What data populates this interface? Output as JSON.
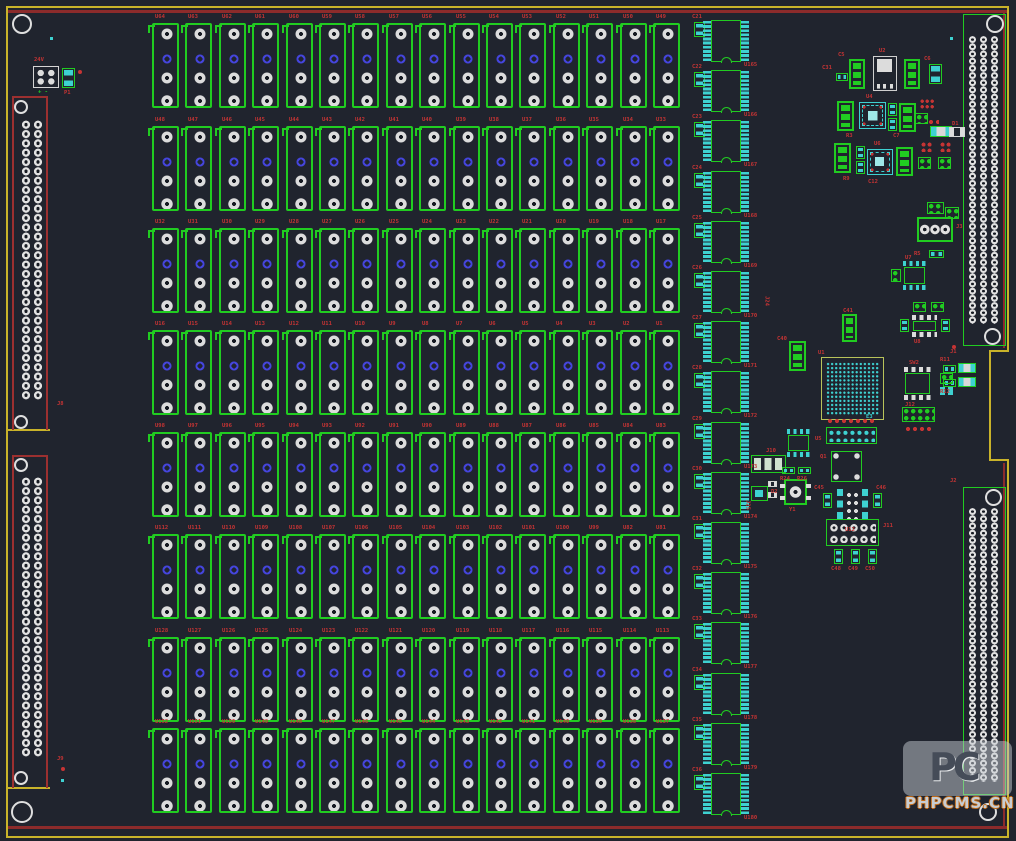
{
  "watermark": {
    "logo": "PC",
    "text": "PHPCMS.CN"
  },
  "colors": {
    "background": "#20242e",
    "board_edge": "#c9b32a",
    "board_line_red": "#8c2b2b",
    "silk_green": "#21cc21",
    "pad_silver": "#dcdcdc",
    "pad_cyan": "#3ed1d1",
    "via_blue": "#4545dd",
    "label_red": "#c63434"
  },
  "board": {
    "width": 1016,
    "height": 841
  },
  "outline": {
    "yellow": [
      [
        6,
        6,
        1003,
        2
      ],
      [
        6,
        6,
        2,
        832
      ],
      [
        6,
        836,
        1003,
        2
      ],
      [
        1007,
        6,
        2,
        346
      ],
      [
        990,
        350,
        19,
        2
      ],
      [
        989,
        350,
        2,
        111
      ],
      [
        990,
        459,
        19,
        2
      ],
      [
        1007,
        461,
        2,
        377
      ],
      [
        6,
        429,
        44,
        2
      ],
      [
        6,
        787,
        44,
        2
      ]
    ],
    "red": [
      [
        8,
        10,
        999,
        3
      ],
      [
        8,
        826,
        999,
        3
      ],
      [
        1003,
        12,
        2,
        336
      ],
      [
        1003,
        463,
        2,
        363
      ]
    ]
  },
  "mount_holes": [
    [
      12,
      14,
      20
    ],
    [
      11,
      801,
      22
    ],
    [
      986,
      15,
      18
    ],
    [
      979,
      803,
      18
    ],
    [
      14,
      100,
      14
    ],
    [
      14,
      415,
      14
    ],
    [
      14,
      458,
      14
    ],
    [
      14,
      771,
      14
    ],
    [
      984,
      328,
      17
    ],
    [
      985,
      489,
      17
    ]
  ],
  "testpoints": [
    [
      50,
      37
    ],
    [
      61,
      779
    ],
    [
      950,
      37
    ]
  ],
  "red_dots": [
    [
      61,
      767
    ],
    [
      78,
      70
    ],
    [
      952,
      345
    ]
  ],
  "relay_grid": {
    "x0": 152,
    "pitch_x": 33.4,
    "w": 27,
    "h": 85,
    "row_tops": [
      23,
      126,
      228,
      330,
      432,
      534,
      637,
      728
    ],
    "labels": [
      [
        "U64",
        "U63",
        "U62",
        "U61",
        "U60",
        "U59",
        "U58",
        "U57",
        "U56",
        "U55",
        "U54",
        "U53",
        "U52",
        "U51",
        "U50",
        "U49"
      ],
      [
        "U48",
        "U47",
        "U46",
        "U45",
        "U44",
        "U43",
        "U42",
        "U41",
        "U40",
        "U39",
        "U38",
        "U37",
        "U36",
        "U35",
        "U34",
        "U33"
      ],
      [
        "U32",
        "U31",
        "U30",
        "U29",
        "U28",
        "U27",
        "U26",
        "U25",
        "U24",
        "U23",
        "U22",
        "U21",
        "U20",
        "U19",
        "U18",
        "U17"
      ],
      [
        "U16",
        "U15",
        "U14",
        "U13",
        "U12",
        "U11",
        "U10",
        "U9",
        "U8",
        "U7",
        "U6",
        "U5",
        "U4",
        "U3",
        "U2",
        "U1"
      ],
      [
        "U98",
        "U97",
        "U96",
        "U95",
        "U94",
        "U93",
        "U92",
        "U91",
        "U90",
        "U89",
        "U88",
        "U87",
        "U86",
        "U85",
        "U84",
        "U83"
      ],
      [
        "U112",
        "U111",
        "U110",
        "U109",
        "U108",
        "U107",
        "U106",
        "U105",
        "U104",
        "U103",
        "U102",
        "U101",
        "U100",
        "U99",
        "U82",
        "U81"
      ],
      [
        "U128",
        "U127",
        "U126",
        "U125",
        "U124",
        "U123",
        "U122",
        "U121",
        "U120",
        "U119",
        "U118",
        "U117",
        "U116",
        "U115",
        "U114",
        "U113"
      ],
      [
        "U152",
        "U151",
        "U150",
        "U149",
        "U148",
        "U147",
        "U146",
        "U145",
        "U144",
        "U143",
        "U142",
        "U141",
        "U140",
        "U139",
        "U138",
        "U137"
      ]
    ]
  },
  "ic_column": {
    "cap_x": 694,
    "pin_l_x": 703,
    "body_x": 711,
    "pin_r_x": 741,
    "top0": 20,
    "pitch": 50.2,
    "body_w": 30,
    "body_h": 42,
    "ic_labels": [
      "U165",
      "U166",
      "U167",
      "U168",
      "U169",
      "U170",
      "U171",
      "U172",
      "U173",
      "U174",
      "U175",
      "U176",
      "U177",
      "U178",
      "U179",
      "U180"
    ],
    "cap_labels": [
      "C21",
      "C22",
      "C23",
      "C24",
      "C25",
      "C26",
      "C27",
      "C28",
      "C29",
      "C30",
      "C31",
      "C32",
      "C33",
      "C34",
      "C35",
      "C36"
    ]
  },
  "left_connectors": [
    {
      "x": 12,
      "y": 96,
      "w": 36,
      "h": 334,
      "pads": [
        20,
        120,
        24,
        280
      ]
    },
    {
      "x": 12,
      "y": 455,
      "w": 36,
      "h": 333,
      "pads": [
        20,
        477,
        24,
        280
      ]
    }
  ],
  "right_connectors": [
    {
      "x": 963,
      "y": 14,
      "w": 43,
      "h": 332,
      "pads": [
        967,
        36,
        33,
        288
      ]
    },
    {
      "x": 963,
      "y": 487,
      "w": 43,
      "h": 308,
      "pads": [
        967,
        508,
        33,
        274
      ]
    }
  ],
  "parts": [
    {
      "t": "w4",
      "x": 33,
      "y": 66,
      "w": 26,
      "h": 22
    },
    {
      "t": "gc2v",
      "x": 62,
      "y": 68,
      "w": 13,
      "h": 20
    },
    {
      "t": "g3",
      "x": 849,
      "y": 59,
      "w": 16,
      "h": 30
    },
    {
      "t": "vreg",
      "x": 873,
      "y": 56,
      "w": 24,
      "h": 35
    },
    {
      "t": "g3",
      "x": 904,
      "y": 59,
      "w": 16,
      "h": 30
    },
    {
      "t": "gc2h",
      "x": 836,
      "y": 73,
      "w": 12,
      "h": 8
    },
    {
      "t": "gc2v",
      "x": 929,
      "y": 64,
      "w": 13,
      "h": 20
    },
    {
      "t": "g3",
      "x": 837,
      "y": 101,
      "w": 17,
      "h": 30
    },
    {
      "t": "qfn",
      "x": 859,
      "y": 102,
      "w": 27,
      "h": 27
    },
    {
      "t": "gc2v",
      "x": 888,
      "y": 103,
      "w": 9,
      "h": 13
    },
    {
      "t": "gc2v",
      "x": 888,
      "y": 118,
      "w": 9,
      "h": 13
    },
    {
      "t": "g3",
      "x": 899,
      "y": 103,
      "w": 17,
      "h": 29
    },
    {
      "t": "r3x3",
      "x": 920,
      "y": 99,
      "w": 15,
      "h": 11
    },
    {
      "t": "g2x2",
      "x": 915,
      "y": 113,
      "w": 13,
      "h": 11
    },
    {
      "t": "rrow",
      "x": 928,
      "y": 119,
      "w": 11,
      "h": 6
    },
    {
      "t": "cyr",
      "x": 930,
      "y": 126,
      "w": 22,
      "h": 11
    },
    {
      "t": "g3",
      "x": 834,
      "y": 143,
      "w": 17,
      "h": 30
    },
    {
      "t": "gc2v",
      "x": 856,
      "y": 146,
      "w": 9,
      "h": 13
    },
    {
      "t": "gc2v",
      "x": 856,
      "y": 161,
      "w": 9,
      "h": 13
    },
    {
      "t": "qfn",
      "x": 867,
      "y": 149,
      "w": 26,
      "h": 26
    },
    {
      "t": "g3",
      "x": 896,
      "y": 147,
      "w": 17,
      "h": 29
    },
    {
      "t": "r2x2",
      "x": 921,
      "y": 142,
      "w": 12,
      "h": 10
    },
    {
      "t": "r2x2",
      "x": 940,
      "y": 142,
      "w": 12,
      "h": 10
    },
    {
      "t": "g2x2",
      "x": 918,
      "y": 157,
      "w": 13,
      "h": 12
    },
    {
      "t": "g2x2",
      "x": 938,
      "y": 157,
      "w": 13,
      "h": 12
    },
    {
      "t": "w2",
      "x": 949,
      "y": 127,
      "w": 16,
      "h": 10
    },
    {
      "t": "g2x2",
      "x": 945,
      "y": 207,
      "w": 14,
      "h": 12
    },
    {
      "t": "g2x2",
      "x": 927,
      "y": 202,
      "w": 17,
      "h": 12
    },
    {
      "t": "term3",
      "x": 917,
      "y": 217,
      "w": 36,
      "h": 25
    },
    {
      "t": "gc2h",
      "x": 929,
      "y": 250,
      "w": 15,
      "h": 8
    },
    {
      "t": "soic8c",
      "x": 901,
      "y": 261,
      "w": 27,
      "h": 29
    },
    {
      "t": "g2x2",
      "x": 891,
      "y": 269,
      "w": 10,
      "h": 13
    },
    {
      "t": "g2x2",
      "x": 913,
      "y": 302,
      "w": 13,
      "h": 10
    },
    {
      "t": "g2x2",
      "x": 931,
      "y": 302,
      "w": 13,
      "h": 10
    },
    {
      "t": "soicW",
      "x": 910,
      "y": 315,
      "w": 29,
      "h": 22
    },
    {
      "t": "gc2v",
      "x": 900,
      "y": 319,
      "w": 9,
      "h": 13
    },
    {
      "t": "gc2v",
      "x": 941,
      "y": 319,
      "w": 9,
      "h": 13
    },
    {
      "t": "gc2h",
      "x": 943,
      "y": 365,
      "w": 13,
      "h": 8
    },
    {
      "t": "gc2h",
      "x": 943,
      "y": 379,
      "w": 13,
      "h": 8
    },
    {
      "t": "cyr",
      "x": 958,
      "y": 363,
      "w": 18,
      "h": 10
    },
    {
      "t": "cyr",
      "x": 958,
      "y": 377,
      "w": 18,
      "h": 10
    },
    {
      "t": "g3",
      "x": 842,
      "y": 314,
      "w": 15,
      "h": 28
    },
    {
      "t": "g3",
      "x": 789,
      "y": 341,
      "w": 17,
      "h": 30
    },
    {
      "t": "bga",
      "x": 821,
      "y": 357,
      "w": 63,
      "h": 63
    },
    {
      "t": "rrow",
      "x": 827,
      "y": 417,
      "w": 49,
      "h": 8
    },
    {
      "t": "hdr2x7",
      "x": 826,
      "y": 427,
      "w": 51,
      "h": 17
    },
    {
      "t": "soicW",
      "x": 902,
      "y": 367,
      "w": 31,
      "h": 33
    },
    {
      "t": "g2x2",
      "x": 940,
      "y": 373,
      "w": 13,
      "h": 11
    },
    {
      "t": "cy2",
      "x": 940,
      "y": 387,
      "w": 13,
      "h": 8
    },
    {
      "t": "g2x2",
      "x": 902,
      "y": 407,
      "w": 33,
      "h": 15
    },
    {
      "t": "rrow",
      "x": 905,
      "y": 425,
      "w": 29,
      "h": 8
    },
    {
      "t": "h3pad",
      "x": 751,
      "y": 455,
      "w": 35,
      "h": 18
    },
    {
      "t": "soic8c",
      "x": 785,
      "y": 429,
      "w": 27,
      "h": 28
    },
    {
      "t": "gc2h",
      "x": 782,
      "y": 467,
      "w": 13,
      "h": 7
    },
    {
      "t": "gc2h",
      "x": 798,
      "y": 467,
      "w": 13,
      "h": 7
    },
    {
      "t": "crystal",
      "x": 784,
      "y": 479,
      "w": 23,
      "h": 26
    },
    {
      "t": "w2",
      "x": 768,
      "y": 481,
      "w": 9,
      "h": 6
    },
    {
      "t": "w2",
      "x": 768,
      "y": 492,
      "w": 9,
      "h": 6
    },
    {
      "t": "sq",
      "x": 751,
      "y": 486,
      "w": 17,
      "h": 15
    },
    {
      "t": "p4c",
      "x": 831,
      "y": 451,
      "w": 31,
      "h": 31
    },
    {
      "t": "dip8c",
      "x": 837,
      "y": 487,
      "w": 31,
      "h": 37
    },
    {
      "t": "gc2v",
      "x": 823,
      "y": 493,
      "w": 9,
      "h": 15
    },
    {
      "t": "gc2v",
      "x": 873,
      "y": 493,
      "w": 9,
      "h": 15
    },
    {
      "t": "hdr2x5",
      "x": 826,
      "y": 519,
      "w": 53,
      "h": 27
    },
    {
      "t": "gc2v",
      "x": 834,
      "y": 549,
      "w": 9,
      "h": 15
    },
    {
      "t": "gc2v",
      "x": 851,
      "y": 549,
      "w": 9,
      "h": 15
    },
    {
      "t": "gc2v",
      "x": 868,
      "y": 549,
      "w": 9,
      "h": 15
    }
  ],
  "texts": [
    {
      "s": "24V",
      "x": 34,
      "y": 58
    },
    {
      "s": "+ -",
      "x": 38,
      "y": 90,
      "c": "green"
    },
    {
      "s": "P1",
      "x": 64,
      "y": 91
    },
    {
      "s": "U2",
      "x": 879,
      "y": 49
    },
    {
      "s": "C5",
      "x": 838,
      "y": 53
    },
    {
      "s": "C6",
      "x": 924,
      "y": 57
    },
    {
      "s": "C31",
      "x": 822,
      "y": 66
    },
    {
      "s": "U4",
      "x": 866,
      "y": 95
    },
    {
      "s": "R3",
      "x": 846,
      "y": 134
    },
    {
      "s": "C7",
      "x": 893,
      "y": 134
    },
    {
      "s": "U6",
      "x": 874,
      "y": 142
    },
    {
      "s": "R9",
      "x": 843,
      "y": 177
    },
    {
      "s": "C12",
      "x": 868,
      "y": 180
    },
    {
      "s": "D1",
      "x": 952,
      "y": 122
    },
    {
      "s": "J3",
      "x": 956,
      "y": 225
    },
    {
      "s": "R5",
      "x": 914,
      "y": 252
    },
    {
      "s": "U7",
      "x": 905,
      "y": 256
    },
    {
      "s": "U8",
      "x": 914,
      "y": 340
    },
    {
      "s": "R11",
      "x": 940,
      "y": 358
    },
    {
      "s": "R12",
      "x": 940,
      "y": 390
    },
    {
      "s": "U1",
      "x": 818,
      "y": 351
    },
    {
      "s": "E3",
      "x": 866,
      "y": 415,
      "c": "cyan"
    },
    {
      "s": "C40",
      "x": 777,
      "y": 337
    },
    {
      "s": "C41",
      "x": 843,
      "y": 309
    },
    {
      "s": "J10",
      "x": 766,
      "y": 449
    },
    {
      "s": "U5",
      "x": 815,
      "y": 437
    },
    {
      "s": "R24",
      "x": 780,
      "y": 477
    },
    {
      "s": "R26",
      "x": 797,
      "y": 477
    },
    {
      "s": "Y1",
      "x": 789,
      "y": 508
    },
    {
      "s": "D2",
      "x": 771,
      "y": 490
    },
    {
      "s": "SW2",
      "x": 909,
      "y": 361
    },
    {
      "s": "J12",
      "x": 905,
      "y": 403
    },
    {
      "s": "Q1",
      "x": 820,
      "y": 455
    },
    {
      "s": "C45",
      "x": 814,
      "y": 486
    },
    {
      "s": "C46",
      "x": 876,
      "y": 486
    },
    {
      "s": "U12",
      "x": 845,
      "y": 528
    },
    {
      "s": "J11",
      "x": 883,
      "y": 524
    },
    {
      "s": "C48",
      "x": 831,
      "y": 567
    },
    {
      "s": "C49",
      "x": 848,
      "y": 567
    },
    {
      "s": "C50",
      "x": 865,
      "y": 567
    },
    {
      "s": "J8",
      "x": 57,
      "y": 402
    },
    {
      "s": "J9",
      "x": 57,
      "y": 757
    },
    {
      "s": "J1",
      "x": 950,
      "y": 350
    },
    {
      "s": "J2",
      "x": 950,
      "y": 479
    },
    {
      "s": "J24",
      "x": 763,
      "y": 296,
      "v": 1
    },
    {
      "s": "J25",
      "x": 744,
      "y": 500,
      "v": 1
    }
  ]
}
